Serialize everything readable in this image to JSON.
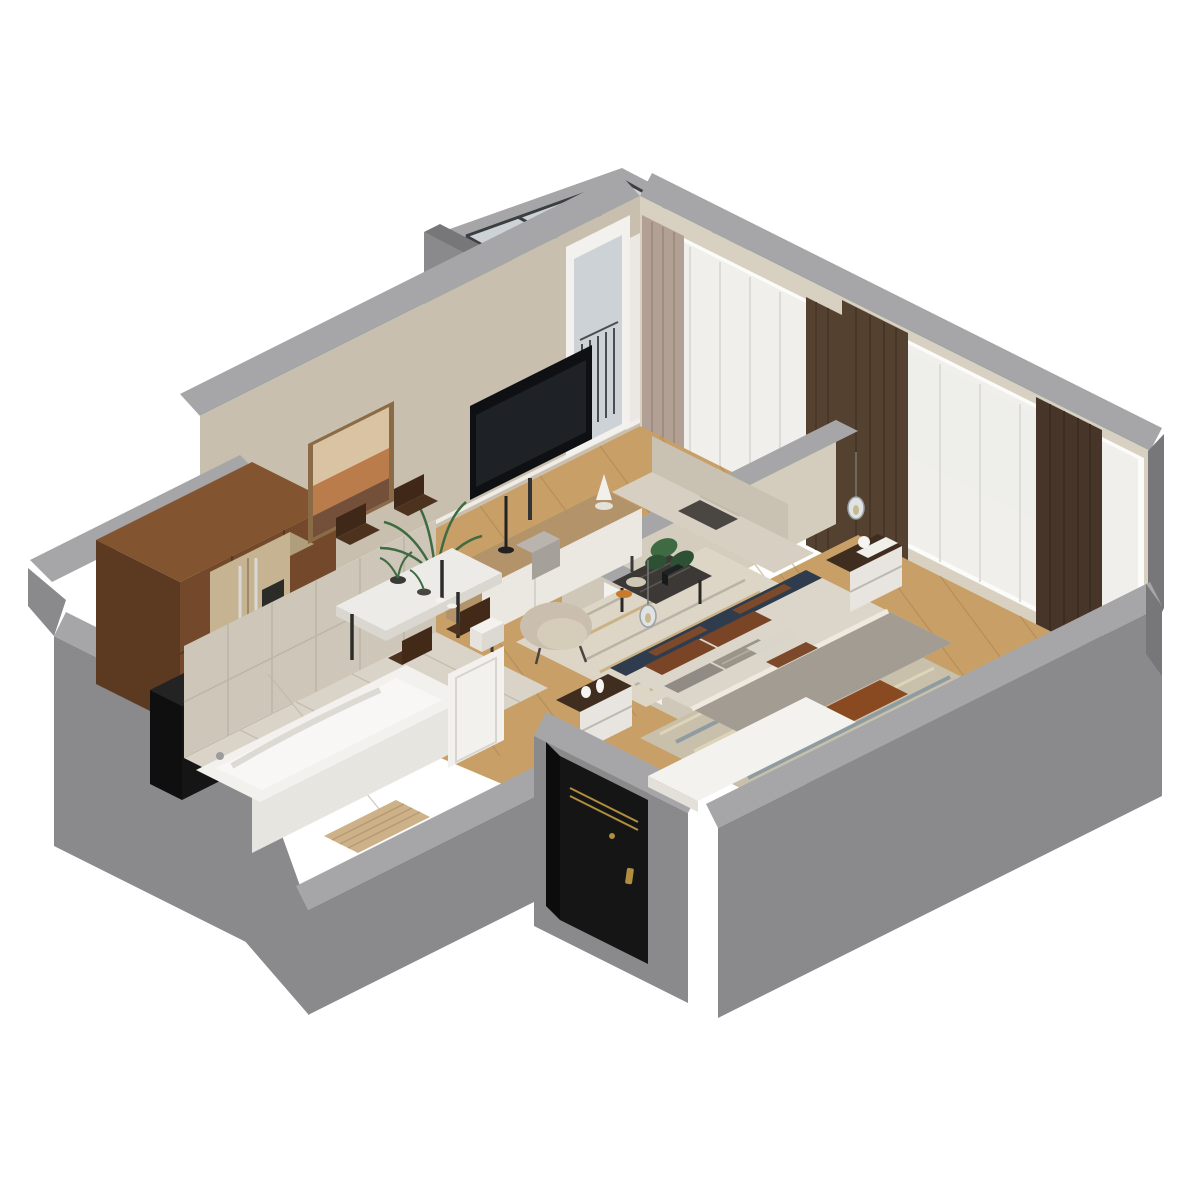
{
  "canvas": {
    "width": 1200,
    "height": 1200,
    "background": "#ffffff",
    "view": "isometric-dollhouse-floorplan"
  },
  "palette": {
    "wallFace": "#8a8a8d",
    "wallTop": "#a6a6a8",
    "wallDark": "#77777a",
    "wallInner": "#bdbdbf",
    "beigeWall": "#c9bfae",
    "creamWall": "#d8d0c0",
    "partBeige": "#d4ccbd",
    "floorWood": "#c79f67",
    "floorSeam": "#a87f4c",
    "tileFloor": "#d9d3c8",
    "tileWall": "#cec6b9",
    "grout": "#bdb5a7",
    "tub": "#f2f1ee",
    "tubFront": "#e7e5e0",
    "tubInner": "#f8f7f5",
    "brown": "#74482a",
    "brownDark": "#5c3921",
    "brownTop": "#835430",
    "fridge": "#c6b392",
    "fridgeTop": "#b09d7c",
    "black": "#151515",
    "oven": "#1c1712",
    "doorWhite": "#f3f1ed",
    "wardTop": "#f4f2ee",
    "bedWard": "#d7be93",
    "bedWardFront": "#c5aa7f",
    "headboard": "#2f3c4e",
    "hbBrown": "#7c4a2a",
    "duvet": "#dcd6ca",
    "blanket": "#a29c92",
    "throw": "#8a4a21",
    "pilBrown": "#7a4526",
    "pilGray": "#908c85",
    "pilLight": "#dad5cb",
    "pilStripe": "#9b9589",
    "rugBed": "#c8c0ab",
    "rugBlue": "#5f7d99",
    "rugLiv": "#ddd6c7",
    "rugGold": "#c2a36a",
    "rugGray": "#a9a49a",
    "sofa": "#d7d0c2",
    "sofaBack": "#c9c2b3",
    "armchair": "#cabfae",
    "armSeat": "#d6ccba",
    "cTable": "#3b3835",
    "green": "#3f6b43",
    "greenDark": "#2e5136",
    "tableTop": "#edebe7",
    "chair": "#4e3220",
    "sheer": "#f1efec",
    "taupe": "#b2a094",
    "curBrown": "#55412f",
    "curBrown2": "#463528",
    "glass": "#ccd2d5",
    "frame": "#3c3f42",
    "tv": "#0e1013",
    "standWood": "#b3946a",
    "standWhite": "#ebe8e2",
    "artA": "#d9c3a2",
    "artB": "#bb7c4c",
    "artC": "#74503a",
    "brass": "#b08d3f",
    "steel": "#d8d8d8"
  },
  "scene": {
    "balcony": {
      "items": [
        "glass-roof-panels",
        "dark-glazing-frame",
        "gray-parapet-walls"
      ]
    },
    "living_room": {
      "items": [
        "wall-art-abstract",
        "flat-tv",
        "tv-stand",
        "table-lamp",
        "speaker",
        "palm-plant",
        "white-planter",
        "dining-table",
        "dining-chairs-x4",
        "area-rug",
        "coffee-table",
        "monstera-plant",
        "decor-bowl",
        "candle-dish",
        "sofa",
        "dark-throw",
        "armchair",
        "balcony-door-with-railing",
        "window-sheer-curtain",
        "taupe-drape"
      ]
    },
    "kitchen": {
      "items": [
        "rust-brown-tall-cabinets",
        "built-in-oven",
        "champagne-fridge",
        "black-counter-column"
      ]
    },
    "bathroom": {
      "items": [
        "bathtub",
        "beige-wall-tiles",
        "tile-floor",
        "wood-bath-mat",
        "white-door"
      ]
    },
    "hallway": {
      "items": [
        "black-entry-door-with-brass-handle",
        "white-wardrobe-top",
        "white-bedroom-door"
      ]
    },
    "bedroom": {
      "items": [
        "double-bed",
        "navy-leather-headboard",
        "pillows-brown-gray-white",
        "gray-blanket",
        "rust-throw",
        "nightstand-left",
        "nightstand-right",
        "white-vases",
        "glass-pendant-lamps-x2",
        "blue-beige-rug",
        "low-wood-wardrobe",
        "corner-chair",
        "window-sheer-curtains",
        "dark-brown-drapes"
      ]
    }
  }
}
